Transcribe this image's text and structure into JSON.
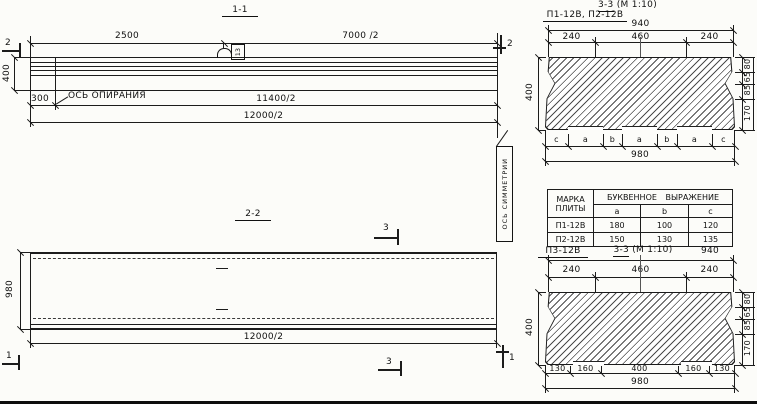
{
  "section_1_1": {
    "title": "1-1",
    "marker_left": "2",
    "marker_right": "2",
    "dim_2500": "2500",
    "dim_7000": "7000 /2",
    "loop_tag": "13",
    "dim_400": "400",
    "dim_300": "300",
    "bearing_axis_label": "ОСЬ ОПИРАНИЯ",
    "dim_11400": "11400/2",
    "dim_12000": "12000/2"
  },
  "symmetry_flag": {
    "label": "ОСЬ СИММЕТРИИ"
  },
  "section_2_2": {
    "title": "2-2",
    "marker_3_top": "3",
    "marker_3_bottom": "3",
    "marker_1_left": "1",
    "marker_1_right": "1",
    "dim_980": "980",
    "dim_12000": "12000/2"
  },
  "section_3_3_top": {
    "plates_label": "П1-12В, П2-12В",
    "title_cut": "3-3",
    "title_scale": "(М 1:10)",
    "dim_940": "940",
    "dims_top": [
      "240",
      "460",
      "240"
    ],
    "dim_400": "400",
    "dims_right": [
      "80",
      "65",
      "85",
      "170"
    ],
    "letters": [
      "c",
      "a",
      "b",
      "a",
      "b",
      "a",
      "c"
    ],
    "dim_980": "980"
  },
  "table": {
    "col_mark_line1": "МАРКА",
    "col_mark_line2": "ПЛИТЫ",
    "col_expr": "БУКВЕННОЕ ВЫРАЖЕНИЕ",
    "sub": [
      "a",
      "b",
      "c"
    ],
    "rows": [
      {
        "mark": "П1-12В",
        "a": "180",
        "b": "100",
        "c": "120"
      },
      {
        "mark": "П2-12В",
        "a": "150",
        "b": "130",
        "c": "135"
      }
    ]
  },
  "section_3_3_bottom": {
    "plate_label": "П3-12В",
    "title_cut": "3-3",
    "title_scale": "(М 1:10)",
    "dim_940": "940",
    "dims_top": [
      "240",
      "460",
      "240"
    ],
    "dim_400": "400",
    "dims_right": [
      "80",
      "65",
      "85",
      "170"
    ],
    "dims_bottom": [
      "130",
      "160",
      "400",
      "160",
      "130"
    ],
    "dim_980": "980"
  }
}
